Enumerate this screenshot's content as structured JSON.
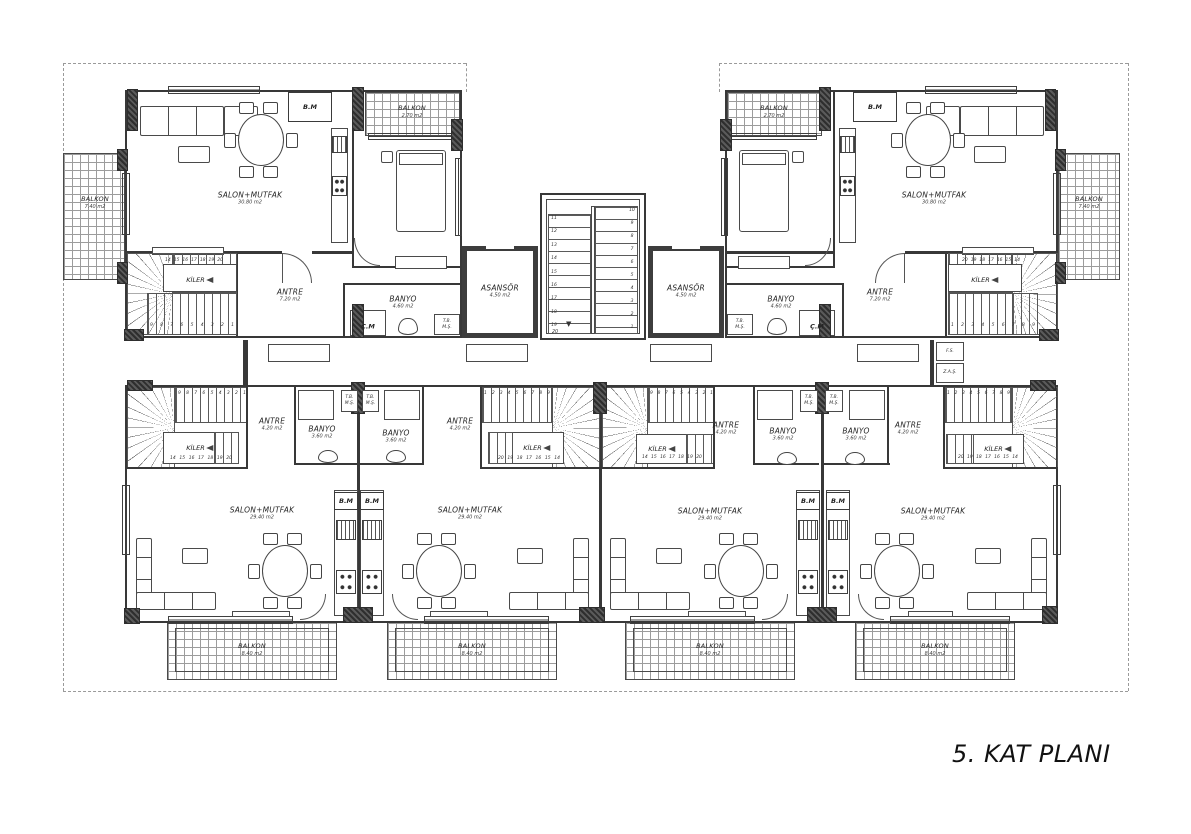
{
  "title": "5. KAT PLANI",
  "rooms": {
    "salon_upper": {
      "name": "SALON+MUTFAK",
      "area": "30.80 m2"
    },
    "salon_lower": {
      "name": "SALON+MUTFAK",
      "area": "29.40 m2"
    },
    "balkon_side": {
      "name": "BALKON",
      "area": "7.40 m2"
    },
    "balkon_top": {
      "name": "BALKON",
      "area": "2.70 m2"
    },
    "balkon_lower": {
      "name": "BALKON",
      "area": "8.40 m2"
    },
    "antre_upper": {
      "name": "ANTRE",
      "area": "7.20 m2"
    },
    "antre_lower": {
      "name": "ANTRE",
      "area": "4.20 m2"
    },
    "banyo_upper": {
      "name": "BANYO",
      "area": "4.60 m2"
    },
    "banyo_lower": {
      "name": "BANYO",
      "area": "3.60 m2"
    },
    "asansor": {
      "name": "ASANSÖR",
      "area": "4.50 m2"
    },
    "kiler": "KİLER",
    "bm": "B.M",
    "cm": "Ç.M",
    "tb": "T.B.",
    "ms": "M.Ş.",
    "fs": "F.S.",
    "zas": "Z.A.Ş."
  },
  "stairs": {
    "center_left": [
      "11",
      "12",
      "13",
      "14",
      "15",
      "16",
      "17",
      "18",
      "19"
    ],
    "center_right": [
      "10",
      "9",
      "8",
      "7",
      "6",
      "5",
      "4",
      "3",
      "2",
      "1"
    ],
    "center_last": "20",
    "flight_down": [
      "9",
      "8",
      "7",
      "6",
      "5",
      "4",
      "3",
      "2",
      "1"
    ],
    "flight_up": [
      "1",
      "2",
      "3",
      "4",
      "5",
      "6",
      "7",
      "8",
      "9"
    ],
    "winder": [
      "14",
      "15",
      "16",
      "17",
      "18",
      "19",
      "20"
    ],
    "winder_rev": [
      "20",
      "19",
      "18",
      "17",
      "16",
      "15",
      "14"
    ]
  }
}
